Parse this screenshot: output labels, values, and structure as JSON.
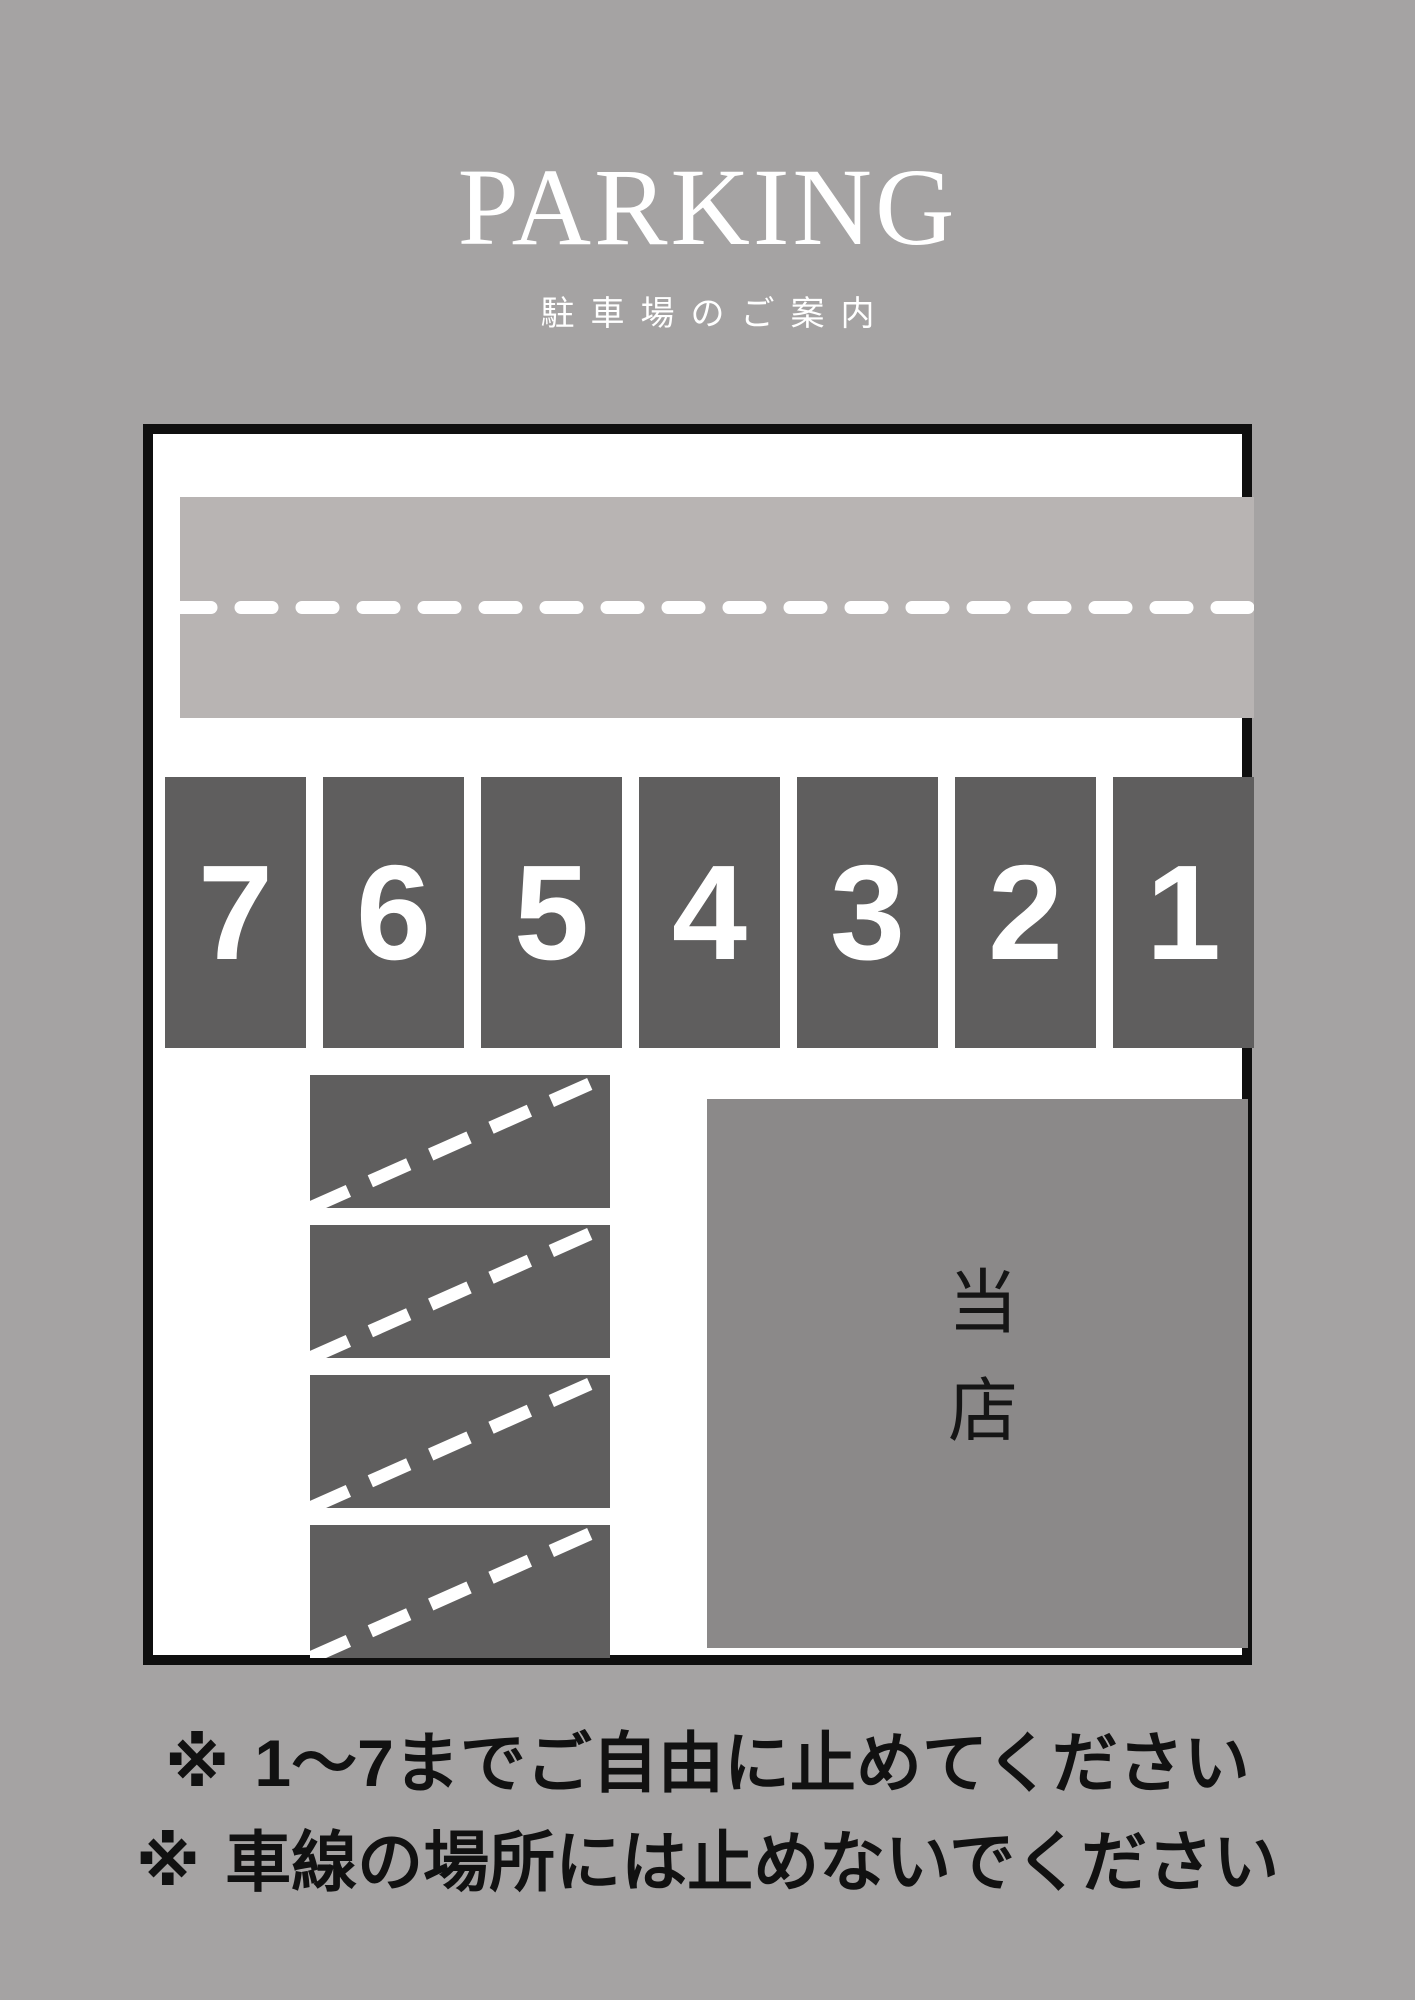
{
  "header": {
    "title": "PARKING",
    "subtitle": "駐車場のご案内"
  },
  "map": {
    "spots": [
      "7",
      "6",
      "5",
      "4",
      "3",
      "2",
      "1"
    ],
    "shop_label": "当店"
  },
  "notes": [
    {
      "marker": "※",
      "text": "1～7までご自由に止めてください"
    },
    {
      "marker": "※",
      "text": "車線の場所には止めないでください"
    }
  ],
  "colors": {
    "page_bg": "#a5a3a3",
    "road_fill": "#b8b4b3",
    "spot_fill": "#5f5e5e",
    "shop_fill": "#8b8989",
    "marking_white": "#ffffff",
    "outline_black": "#0f0f0f",
    "note_text": "#111111"
  }
}
